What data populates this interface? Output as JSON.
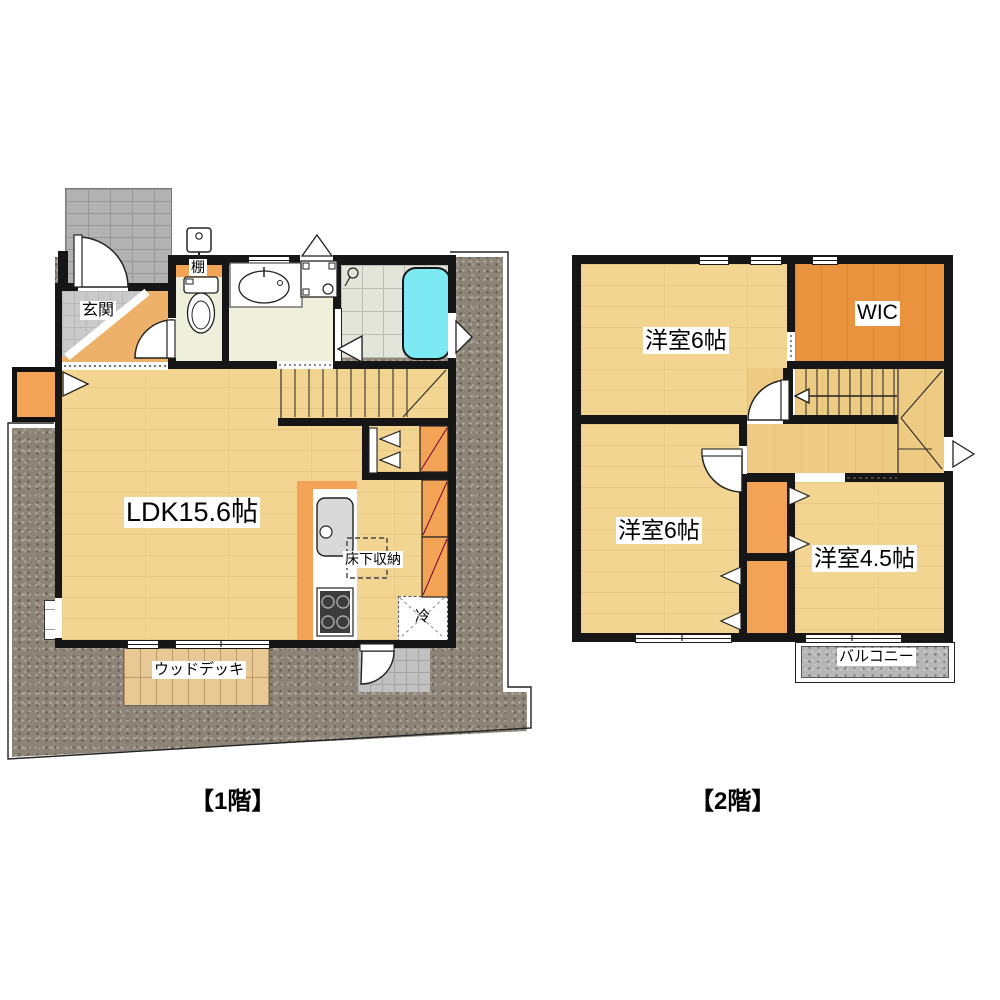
{
  "title": "2階建て住宅 間取り図",
  "floor1": {
    "caption": "【1階】",
    "labels": {
      "genkan": "玄関",
      "shelf": "棚",
      "ldk": "LDK15.6帖",
      "floor_storage": "床下収納",
      "fridge": "冷",
      "wood_deck": "ウッドデッキ"
    }
  },
  "floor2": {
    "caption": "【2階】",
    "labels": {
      "bedroom_upper": "洋室6帖",
      "wic": "WIC",
      "bedroom_lower": "洋室6帖",
      "bedroom_small": "洋室4.5帖",
      "balcony": "バルコニー"
    }
  },
  "colors": {
    "wall": "#161616",
    "wood_floor": "#f3d592",
    "hall_orange": "#edb169",
    "closet_orange": "#f3a356",
    "wic_orange": "#e9933e",
    "bathtub_cyan": "#7de9f2",
    "gravel_gray": "#8d8478",
    "balcony_gray": "#b6b6b6"
  }
}
